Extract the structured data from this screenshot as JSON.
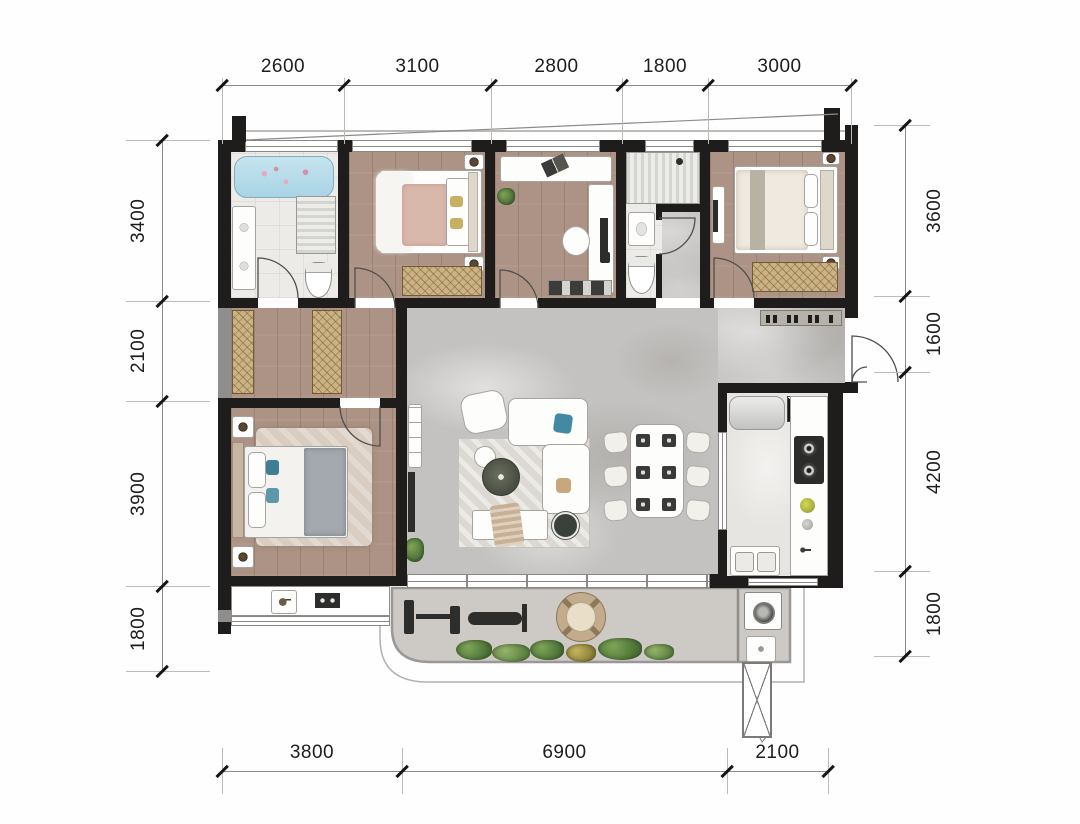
{
  "dimensions": {
    "top": [
      "2600",
      "3100",
      "2800",
      "1800",
      "3000"
    ],
    "bottom": [
      "3800",
      "6900",
      "2100"
    ],
    "left": [
      "3400",
      "2100",
      "3900",
      "1800"
    ],
    "right": [
      "3600",
      "1600",
      "4200",
      "1800"
    ]
  },
  "colors": {
    "wall": "#1e1d1b",
    "wallg": "#8f8e8c",
    "wood": "#ac9385",
    "marble": "#c4c2c0",
    "tile": "#edebe8",
    "kfloor": "#e7e5e1",
    "bfloor": "#cdcac5",
    "wardrobe": "#cdb284",
    "wline": "#6f5c35",
    "tub": "#a9d4e5",
    "pink": "#d9b8ac",
    "linen": "#f4f2ee",
    "grayt": "#a4a9af",
    "teal": "#3e7f96",
    "tan": "#c9b095",
    "plant": "#5d8046",
    "dark": "#2d2d2b",
    "dline": "#8c8a88",
    "dtext": "#1d1d1d"
  }
}
